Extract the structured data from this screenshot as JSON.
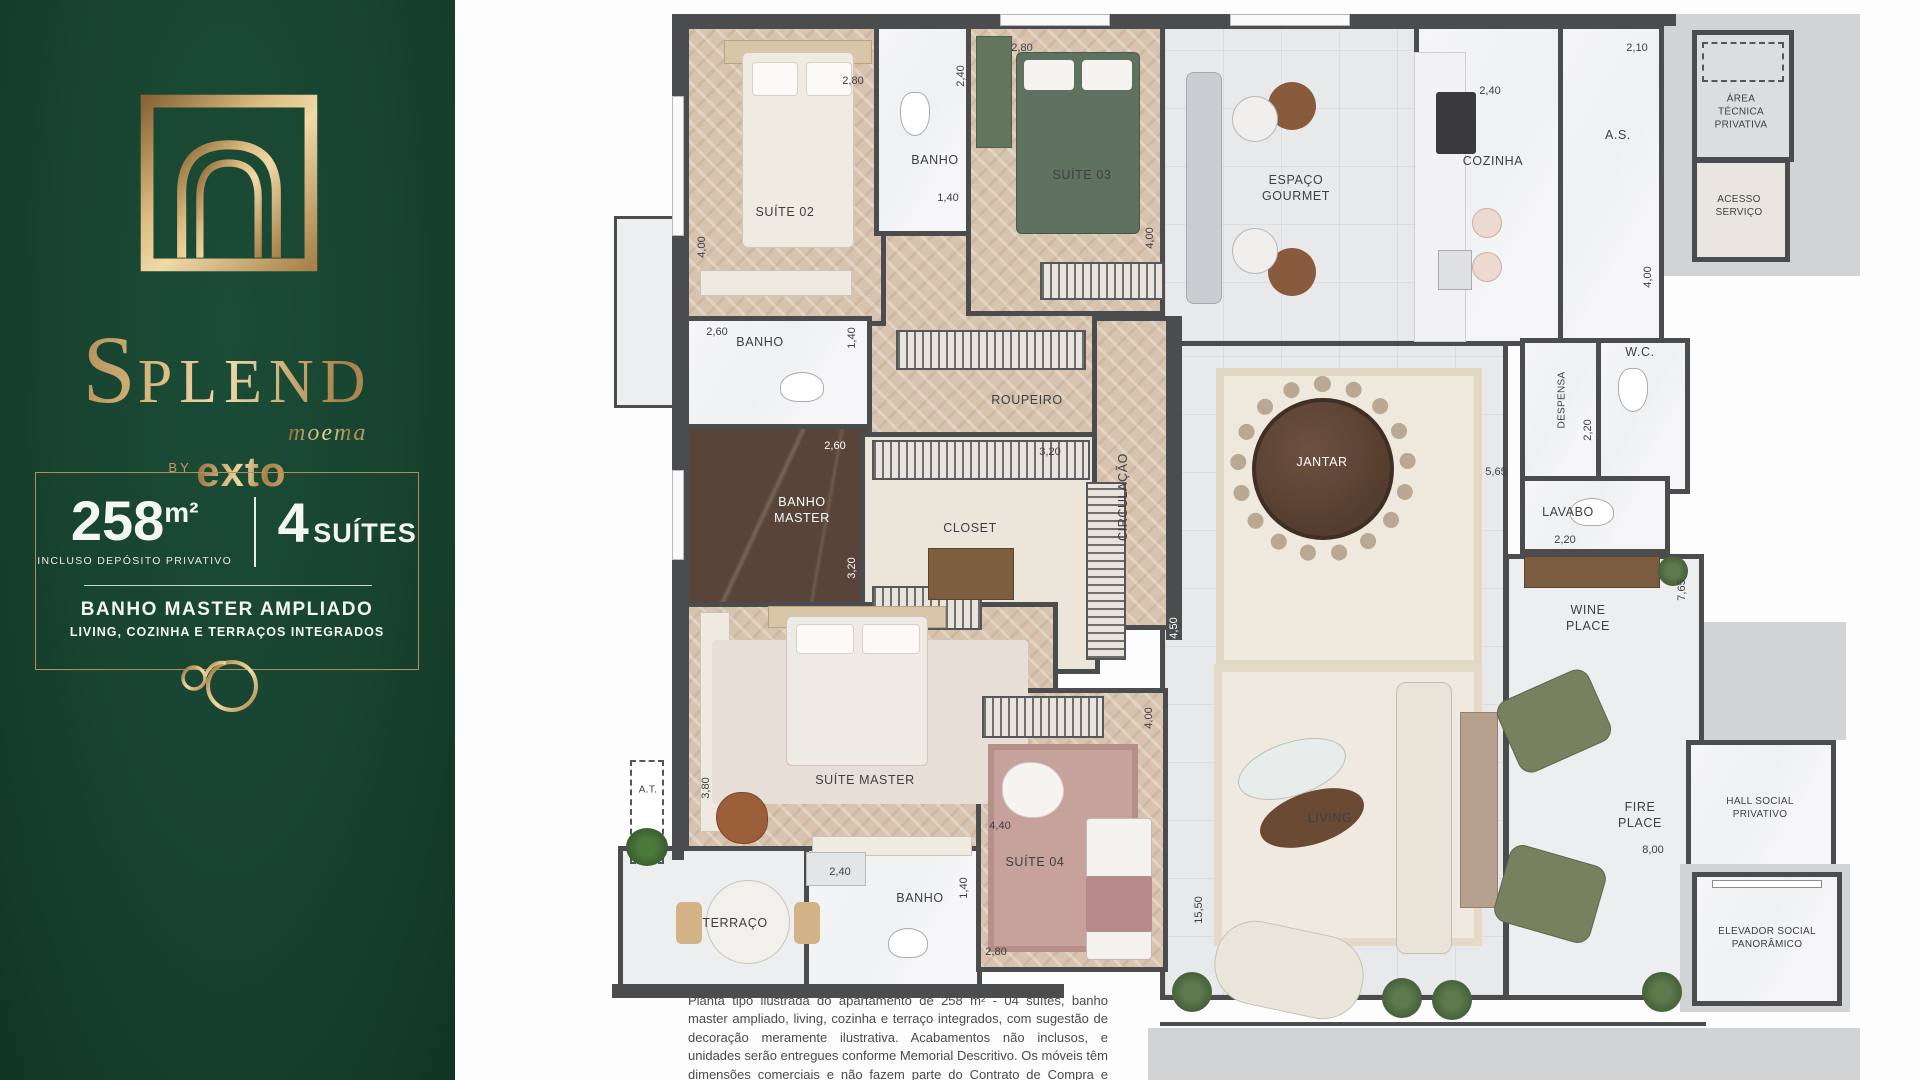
{
  "palette": {
    "panel_green": "#17432F",
    "gold": "#C19A5F",
    "wall": "#4B4C4E",
    "wood": "#D7C3AE",
    "olive": "#77815F",
    "rose": "#C7A29D"
  },
  "brand": {
    "name": "SPLEND",
    "location": "moema",
    "by_label": "BY",
    "developer": "exto"
  },
  "info": {
    "area_value": "258",
    "area_unit": "m²",
    "area_note": "INCLUSO DEPÓSITO PRIVATIVO",
    "suites_value": "4",
    "suites_label": "SUÍTES",
    "highlight_1": "BANHO MASTER AMPLIADO",
    "highlight_2": "LIVING, COZINHA E TERRAÇOS INTEGRADOS"
  },
  "plan": {
    "rooms": [
      {
        "id": "suite-02",
        "label": "SUÍTE 02"
      },
      {
        "id": "banho-suite-02",
        "label": "BANHO"
      },
      {
        "id": "suite-03",
        "label": "SUÍTE 03"
      },
      {
        "id": "espaco-gourmet",
        "label": "ESPAÇO\nGOURMET"
      },
      {
        "id": "cozinha",
        "label": "COZINHA"
      },
      {
        "id": "area-servico",
        "label": "A.S."
      },
      {
        "id": "area-tecnica",
        "label": "ÁREA\nTÉCNICA\nPRIVATIVA"
      },
      {
        "id": "acesso-servico",
        "label": "ACESSO\nSERVIÇO"
      },
      {
        "id": "banho-social",
        "label": "BANHO"
      },
      {
        "id": "roupeiro",
        "label": "ROUPEIRO"
      },
      {
        "id": "banho-master",
        "label": "BANHO\nMASTER"
      },
      {
        "id": "closet",
        "label": "CLOSET"
      },
      {
        "id": "circulacao",
        "label": "CIRCULAÇÃO"
      },
      {
        "id": "jantar",
        "label": "JANTAR"
      },
      {
        "id": "despensa",
        "label": "DESPENSA"
      },
      {
        "id": "wc",
        "label": "W.C."
      },
      {
        "id": "lavabo",
        "label": "LAVABO"
      },
      {
        "id": "wine-place",
        "label": "WINE\nPLACE"
      },
      {
        "id": "suite-master",
        "label": "SUÍTE MASTER"
      },
      {
        "id": "at",
        "label": "A.T."
      },
      {
        "id": "terraco",
        "label": "TERRAÇO"
      },
      {
        "id": "banho-suite-04",
        "label": "BANHO"
      },
      {
        "id": "suite-04",
        "label": "SUÍTE 04"
      },
      {
        "id": "living",
        "label": "LIVING"
      },
      {
        "id": "fire-place",
        "label": "FIRE\nPLACE"
      },
      {
        "id": "hall-social",
        "label": "HALL SOCIAL\nPRIVATIVO"
      },
      {
        "id": "elevador",
        "label": "ELEVADOR SOCIAL\nPANORÂMICO"
      }
    ],
    "dims": [
      {
        "value": "2,80"
      },
      {
        "value": "4,00"
      },
      {
        "value": "2,40"
      },
      {
        "value": "1,40"
      },
      {
        "value": "2,80"
      },
      {
        "value": "4,00"
      },
      {
        "value": "2,40"
      },
      {
        "value": "2,10"
      },
      {
        "value": "4,00"
      },
      {
        "value": "2,60"
      },
      {
        "value": "1,40"
      },
      {
        "value": "2,60"
      },
      {
        "value": "3,20"
      },
      {
        "value": "3,20"
      },
      {
        "value": "2,20"
      },
      {
        "value": "5,65"
      },
      {
        "value": "2,20"
      },
      {
        "value": "7,65"
      },
      {
        "value": "3,80"
      },
      {
        "value": "4,40"
      },
      {
        "value": "4,50"
      },
      {
        "value": "2,40"
      },
      {
        "value": "1,40"
      },
      {
        "value": "2,80"
      },
      {
        "value": "4,00"
      },
      {
        "value": "15,50"
      },
      {
        "value": "8,00"
      }
    ]
  },
  "disclaimer": "Planta tipo ilustrada do apartamento de 258 m² - 04 suítes, banho master ampliado, living, cozinha e terraço integrados, com sugestão de decoração meramente ilustrativa. Acabamentos não inclusos, e unidades serão entregues conforme Memorial Descritivo. Os móveis têm dimensões comerciais e não fazem parte do Contrato de Compra e Venda."
}
